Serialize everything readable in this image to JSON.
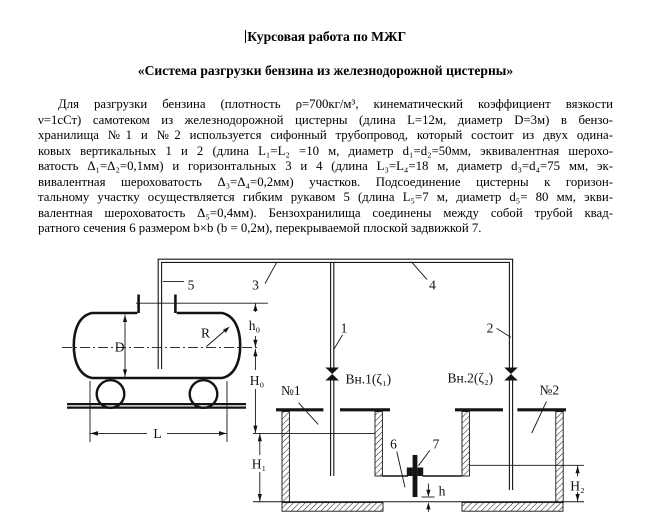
{
  "document": {
    "title": "Курсовая работа по МЖГ",
    "subtitle": "«Система разгрузки бензина из железнодорожной цистерны»",
    "paragraph_lines": [
      "Для разгрузки бензина (плотность ρ=700кг/м³, кинематический коэффициент вязкости",
      "ν=1сСт) самотеком из железнодорожной цистерны (длина L=12м, диаметр D=3м) в бензо-",
      "хранилища №1 и №2 используется сифонный трубопровод, который состоит из двух одина-",
      "ковых вертикальных 1 и 2 (длина L₁=L₂ =10 м, диаметр d₁=d₂=50мм, эквивалентная шерохо-",
      "ватость Δ₁=Δ₂=0,1мм) и горизонтальных 3 и 4 (длина L₃=L₄=18 м, диаметр d₃=d₄=75 мм, эк-",
      "вивалентная шероховатость Δ₃=Δ₄=0,2мм) участков. Подсоединение цистерны к горизон-",
      "тальному участку осуществляется гибким рукавом 5 (длина L₅=7 м, диаметр d₅= 80 мм, экви-",
      "валентная шероховатость Δ₅=0,4мм). Бензохранилища соединены между собой трубой квад-",
      "ратного сечения 6 размером b×b (b = 0,2м), перекрываемой плоской задвижкой 7."
    ]
  },
  "diagram": {
    "line_color": "#141414",
    "labels": {
      "hose": "5",
      "horiz3": "3",
      "horiz4": "4",
      "vert1": "1",
      "vert2": "2",
      "valve1": "Вн.1(ζ₁)",
      "valve2": "Вн.2(ζ₂)",
      "tank1": "№1",
      "tank2": "№2",
      "pipe6": "6",
      "gate7": "7"
    },
    "dims": {
      "h0": "h₀",
      "H0": "H₀",
      "H1": "H₁",
      "H2": "H₂",
      "D": "D",
      "R": "R",
      "L": "L",
      "h": "h"
    }
  }
}
